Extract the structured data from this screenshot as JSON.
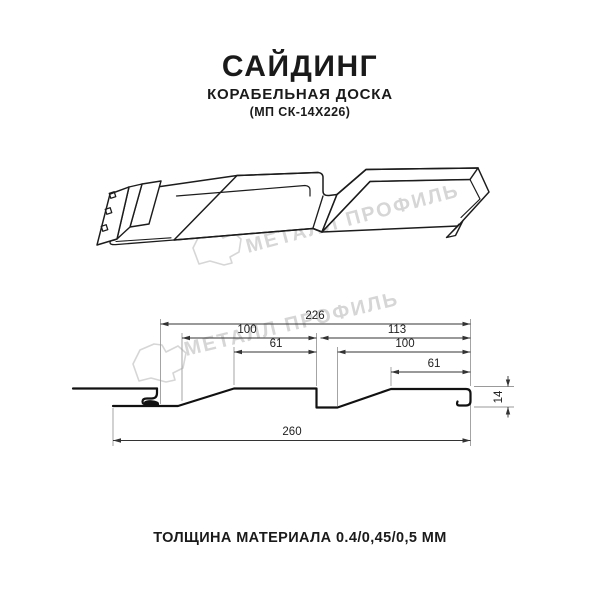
{
  "title": {
    "product": "САЙДИНГ",
    "variant": "КОРАБЕЛЬНАЯ ДОСКА",
    "model_code": "(МП СК-14Х226)"
  },
  "watermark": {
    "brand": "МЕТАЛЛ ПРОФИЛЬ",
    "color": "#d6d6d6"
  },
  "section_dimensions": {
    "total_top": "226",
    "left_span": "100",
    "right_span": "113",
    "left_flat": "61",
    "right_inner": "100",
    "right_flat": "61",
    "profile_height": "14",
    "overall_bottom": "260"
  },
  "footer": {
    "thickness_note": "ТОЛЩИНА МАТЕРИАЛА 0.4/0,45/0,5 ММ"
  }
}
